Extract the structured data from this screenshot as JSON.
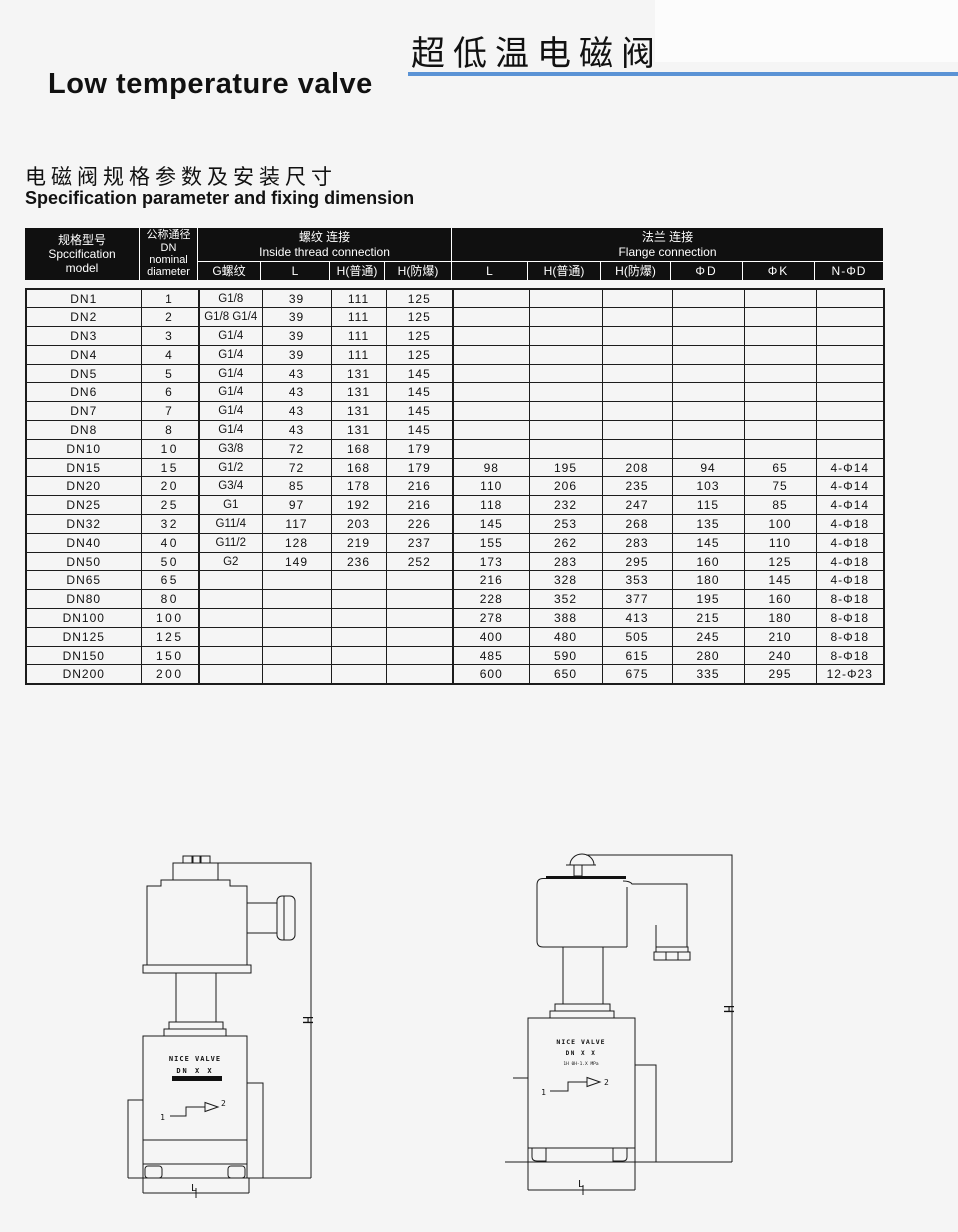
{
  "page": {
    "title_cn": "超低温电磁阀",
    "title_en": "Low temperature valve",
    "section_title_cn": "电磁阀规格参数及安装尺寸",
    "section_title_en": "Specification parameter and fixing dimension"
  },
  "colors": {
    "accent_blue": "#5b93d5",
    "header_bg": "#101010"
  },
  "table": {
    "header": {
      "spec": {
        "cn": "规格型号",
        "en1": "Spccification",
        "en2": "model"
      },
      "dn": {
        "cn": "公称通径",
        "l2": "DN",
        "l3": "nominal",
        "l4": "diameter"
      },
      "thread": {
        "cn": "螺纹 连接",
        "en": "Inside thread connection",
        "cols": [
          "G螺纹",
          "L",
          "H(普通)",
          "H(防爆)"
        ]
      },
      "flange": {
        "cn": "法兰 连接",
        "en": "Flange connection",
        "cols": [
          "L",
          "H(普通)",
          "H(防爆)",
          "ΦD",
          "ΦK",
          "N-ΦD"
        ]
      }
    },
    "rows": [
      [
        "DN1",
        "1",
        "G1/8",
        "39",
        "111",
        "125",
        "",
        "",
        "",
        "",
        "",
        ""
      ],
      [
        "DN2",
        "2",
        "G1/8 G1/4",
        "39",
        "111",
        "125",
        "",
        "",
        "",
        "",
        "",
        ""
      ],
      [
        "DN3",
        "3",
        "G1/4",
        "39",
        "111",
        "125",
        "",
        "",
        "",
        "",
        "",
        ""
      ],
      [
        "DN4",
        "4",
        "G1/4",
        "39",
        "111",
        "125",
        "",
        "",
        "",
        "",
        "",
        ""
      ],
      [
        "DN5",
        "5",
        "G1/4",
        "43",
        "131",
        "145",
        "",
        "",
        "",
        "",
        "",
        ""
      ],
      [
        "DN6",
        "6",
        "G1/4",
        "43",
        "131",
        "145",
        "",
        "",
        "",
        "",
        "",
        ""
      ],
      [
        "DN7",
        "7",
        "G1/4",
        "43",
        "131",
        "145",
        "",
        "",
        "",
        "",
        "",
        ""
      ],
      [
        "DN8",
        "8",
        "G1/4",
        "43",
        "131",
        "145",
        "",
        "",
        "",
        "",
        "",
        ""
      ],
      [
        "DN10",
        "10",
        "G3/8",
        "72",
        "168",
        "179",
        "",
        "",
        "",
        "",
        "",
        ""
      ],
      [
        "DN15",
        "15",
        "G1/2",
        "72",
        "168",
        "179",
        "98",
        "195",
        "208",
        "94",
        "65",
        "4-Φ14"
      ],
      [
        "DN20",
        "20",
        "G3/4",
        "85",
        "178",
        "216",
        "110",
        "206",
        "235",
        "103",
        "75",
        "4-Φ14"
      ],
      [
        "DN25",
        "25",
        "G1",
        "97",
        "192",
        "216",
        "118",
        "232",
        "247",
        "115",
        "85",
        "4-Φ14"
      ],
      [
        "DN32",
        "32",
        "G11/4",
        "117",
        "203",
        "226",
        "145",
        "253",
        "268",
        "135",
        "100",
        "4-Φ18"
      ],
      [
        "DN40",
        "40",
        "G11/2",
        "128",
        "219",
        "237",
        "155",
        "262",
        "283",
        "145",
        "110",
        "4-Φ18"
      ],
      [
        "DN50",
        "50",
        "G2",
        "149",
        "236",
        "252",
        "173",
        "283",
        "295",
        "160",
        "125",
        "4-Φ18"
      ],
      [
        "DN65",
        "65",
        "",
        "",
        "",
        "",
        "216",
        "328",
        "353",
        "180",
        "145",
        "4-Φ18"
      ],
      [
        "DN80",
        "80",
        "",
        "",
        "",
        "",
        "228",
        "352",
        "377",
        "195",
        "160",
        "8-Φ18"
      ],
      [
        "DN100",
        "100",
        "",
        "",
        "",
        "",
        "278",
        "388",
        "413",
        "215",
        "180",
        "8-Φ18"
      ],
      [
        "DN125",
        "125",
        "",
        "",
        "",
        "",
        "400",
        "480",
        "505",
        "245",
        "210",
        "8-Φ18"
      ],
      [
        "DN150",
        "150",
        "",
        "",
        "",
        "",
        "485",
        "590",
        "615",
        "280",
        "240",
        "8-Φ18"
      ],
      [
        "DN200",
        "200",
        "",
        "",
        "",
        "",
        "600",
        "650",
        "675",
        "335",
        "295",
        "12-Φ23"
      ]
    ]
  },
  "drawings": {
    "left": {
      "brand": "NICE VALVE",
      "model": "DN X X",
      "port_in": "1",
      "port_out": "2",
      "dim_height": "H",
      "dim_length": "L"
    },
    "right": {
      "brand": "NICE VALVE",
      "model": "DN X X",
      "spec_line": "1H 0H-1.X MPa",
      "port_in": "1",
      "port_out": "2",
      "dim_height": "H",
      "dim_length": "L"
    }
  }
}
